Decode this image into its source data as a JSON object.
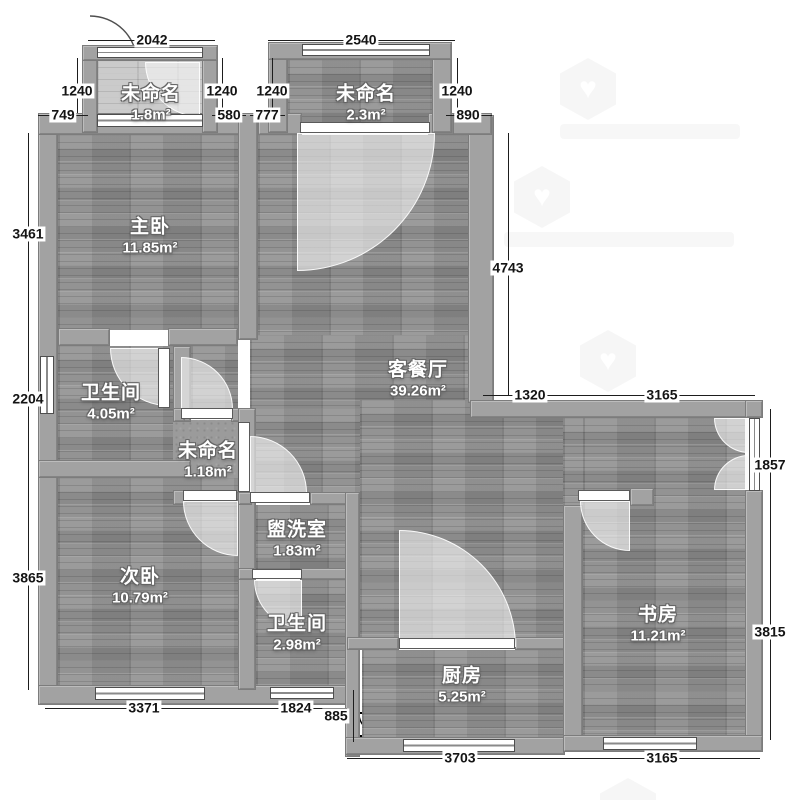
{
  "floorplan": {
    "rooms": [
      {
        "id": "balcony-top-left",
        "name": "未命名",
        "area": "1.8m²",
        "cx": 151,
        "cy": 104
      },
      {
        "id": "balcony-top-middle",
        "name": "未命名",
        "area": "2.3m²",
        "cx": 366,
        "cy": 104
      },
      {
        "id": "master-bedroom",
        "name": "主卧",
        "area": "11.85m²",
        "cx": 150,
        "cy": 237
      },
      {
        "id": "living-dining-room",
        "name": "客餐厅",
        "area": "39.26m²",
        "cx": 418,
        "cy": 380
      },
      {
        "id": "bathroom-1",
        "name": "卫生间",
        "area": "4.05m²",
        "cx": 111,
        "cy": 403
      },
      {
        "id": "hallway-unnamed",
        "name": "未命名",
        "area": "1.18m²",
        "cx": 208,
        "cy": 461
      },
      {
        "id": "second-bedroom",
        "name": "次卧",
        "area": "10.79m²",
        "cx": 140,
        "cy": 587
      },
      {
        "id": "washroom",
        "name": "盥洗室",
        "area": "1.83m²",
        "cx": 297,
        "cy": 540
      },
      {
        "id": "bathroom-2",
        "name": "卫生间",
        "area": "2.98m²",
        "cx": 297,
        "cy": 634
      },
      {
        "id": "kitchen",
        "name": "厨房",
        "area": "5.25m²",
        "cx": 462,
        "cy": 686
      },
      {
        "id": "study",
        "name": "书房",
        "area": "11.21m²",
        "cx": 658,
        "cy": 625
      }
    ],
    "dimension_chains": [
      {
        "dir": "h",
        "pos": 40,
        "from": 88,
        "to": 215,
        "ticks": [
          88,
          215
        ],
        "labels": [
          {
            "value": "2042",
            "at": 152
          }
        ]
      },
      {
        "dir": "h",
        "pos": 40,
        "from": 268,
        "to": 455,
        "ticks": [
          268,
          455
        ],
        "labels": [
          {
            "value": "2540",
            "at": 361
          }
        ]
      },
      {
        "dir": "v",
        "pos": 77,
        "from": 58,
        "to": 113,
        "ticks": [
          58,
          113
        ],
        "labels": [
          {
            "value": "1240",
            "at": 91
          }
        ]
      },
      {
        "dir": "v",
        "pos": 222,
        "from": 58,
        "to": 113,
        "ticks": [
          58,
          113
        ],
        "labels": [
          {
            "value": "1240",
            "at": 91
          }
        ]
      },
      {
        "dir": "v",
        "pos": 272,
        "from": 58,
        "to": 113,
        "ticks": [
          58,
          113
        ],
        "labels": [
          {
            "value": "1240",
            "at": 91
          }
        ]
      },
      {
        "dir": "v",
        "pos": 457,
        "from": 58,
        "to": 113,
        "ticks": [
          58,
          113
        ],
        "labels": [
          {
            "value": "1240",
            "at": 91
          }
        ]
      },
      {
        "dir": "h",
        "pos": 115,
        "from": 38,
        "to": 88,
        "ticks": [
          38,
          88
        ],
        "labels": [
          {
            "value": "749",
            "at": 63
          }
        ]
      },
      {
        "dir": "h",
        "pos": 115,
        "from": 212,
        "to": 246,
        "ticks": [
          212,
          246
        ],
        "labels": [
          {
            "value": "580",
            "at": 229
          }
        ]
      },
      {
        "dir": "h",
        "pos": 115,
        "from": 250,
        "to": 285,
        "ticks": [
          250,
          285
        ],
        "labels": [
          {
            "value": "777",
            "at": 267
          }
        ]
      },
      {
        "dir": "h",
        "pos": 115,
        "from": 446,
        "to": 492,
        "ticks": [
          446,
          492
        ],
        "labels": [
          {
            "value": "890",
            "at": 468
          }
        ]
      },
      {
        "dir": "v",
        "pos": 28,
        "from": 133,
        "to": 690,
        "ticks": [
          133,
          333,
          462,
          690
        ],
        "labels": [
          {
            "value": "3461",
            "at": 234
          },
          {
            "value": "2204",
            "at": 399
          },
          {
            "value": "3865",
            "at": 578
          }
        ]
      },
      {
        "dir": "v",
        "pos": 508,
        "from": 133,
        "to": 395,
        "ticks": [
          133,
          395
        ],
        "labels": [
          {
            "value": "4743",
            "at": 268
          }
        ]
      },
      {
        "dir": "h",
        "pos": 395,
        "from": 483,
        "to": 755,
        "ticks": [
          483,
          570,
          755
        ],
        "labels": [
          {
            "value": "1320",
            "at": 530
          },
          {
            "value": "3165",
            "at": 662
          }
        ]
      },
      {
        "dir": "v",
        "pos": 770,
        "from": 409,
        "to": 740,
        "ticks": [
          409,
          517,
          740
        ],
        "labels": [
          {
            "value": "1857",
            "at": 465
          },
          {
            "value": "3815",
            "at": 632
          }
        ]
      },
      {
        "dir": "h",
        "pos": 708,
        "from": 45,
        "to": 347,
        "ticks": [
          45,
          242,
          347
        ],
        "labels": [
          {
            "value": "3371",
            "at": 144
          },
          {
            "value": "1824",
            "at": 296
          }
        ]
      },
      {
        "dir": "v",
        "pos": 353,
        "from": 690,
        "to": 742,
        "ticks": [
          690,
          742
        ],
        "labels": [
          {
            "value": "885",
            "at": 716,
            "off": -17
          }
        ]
      },
      {
        "dir": "h",
        "pos": 758,
        "from": 347,
        "to": 760,
        "ticks": [
          347,
          615,
          760
        ],
        "labels": [
          {
            "value": "3703",
            "at": 460
          },
          {
            "value": "3165",
            "at": 662
          }
        ]
      }
    ]
  }
}
